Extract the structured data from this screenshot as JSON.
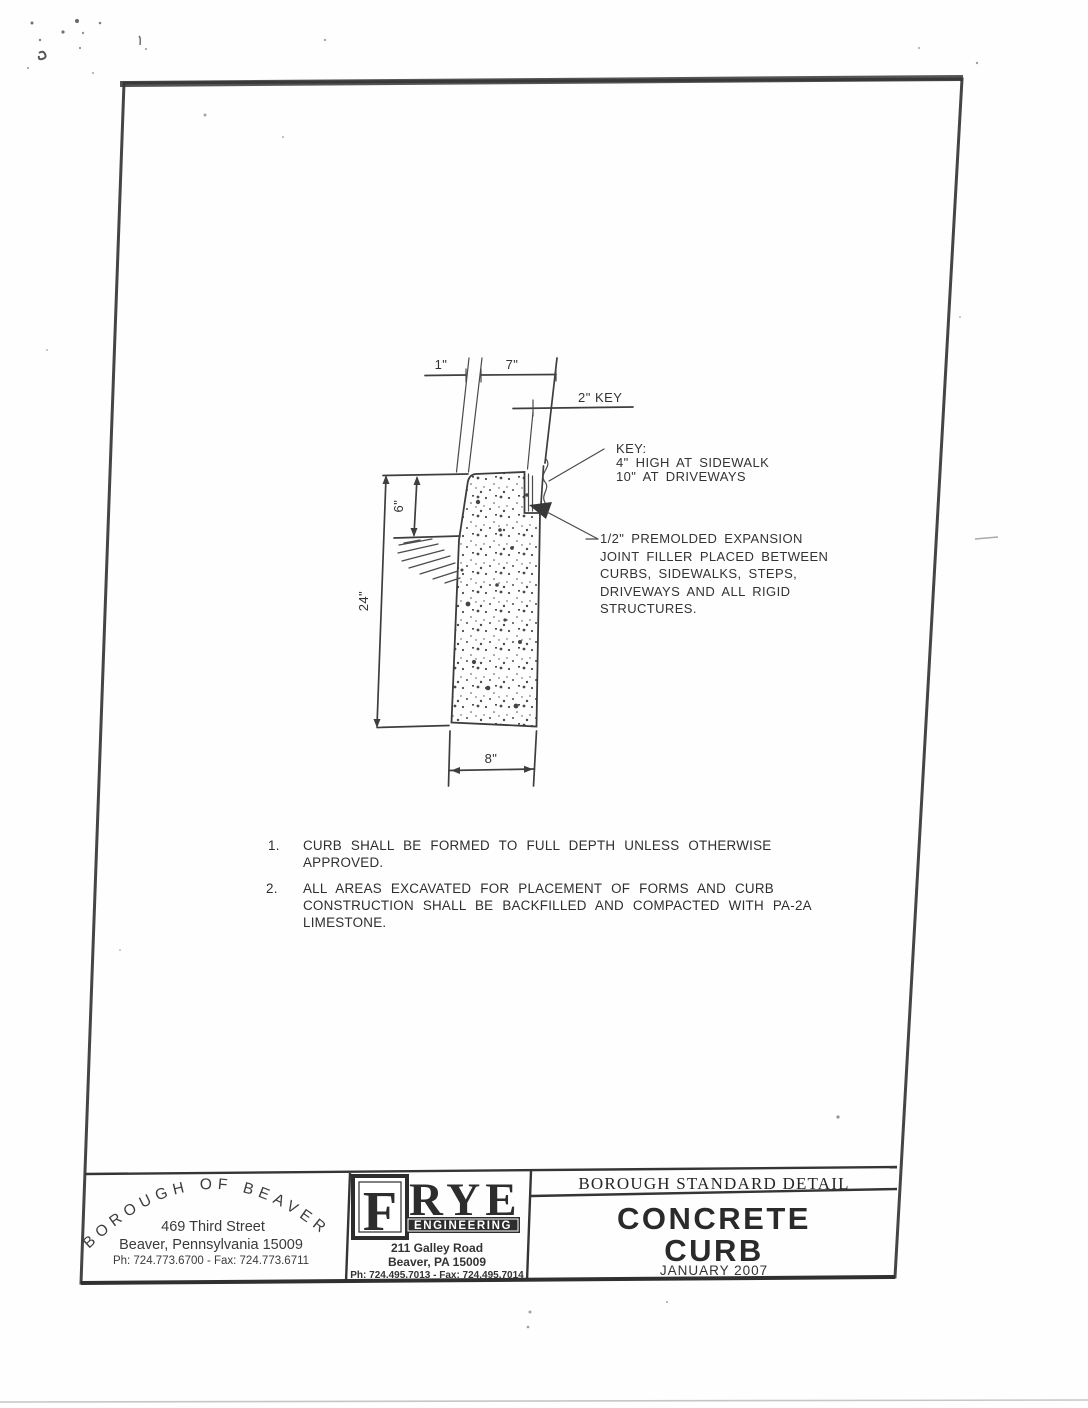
{
  "drawing": {
    "dims": {
      "batter": "1\"",
      "top_width": "7\"",
      "key_width": "2\" KEY",
      "reveal": "6\"",
      "depth": "24\"",
      "base": "8\""
    },
    "key_note": {
      "l1": "KEY:",
      "l2": "4\" HIGH AT SIDEWALK",
      "l3": "10\" AT DRIVEWAYS"
    },
    "joint_note": {
      "l1": "1/2\" PREMOLDED EXPANSION",
      "l2": "JOINT FILLER PLACED BETWEEN",
      "l3": "CURBS, SIDEWALKS, STEPS,",
      "l4": "DRIVEWAYS AND ALL RIGID",
      "l5": "STRUCTURES."
    }
  },
  "notes": {
    "n1": {
      "num": "1.",
      "line1": "CURB SHALL BE FORMED TO FULL DEPTH UNLESS OTHERWISE",
      "line2": "APPROVED."
    },
    "n2": {
      "num": "2.",
      "line1": "ALL AREAS EXCAVATED FOR PLACEMENT OF FORMS AND CURB",
      "line2": "CONSTRUCTION SHALL BE BACKFILLED AND COMPACTED WITH PA-2A",
      "line3": "LIMESTONE."
    }
  },
  "title_block": {
    "borough": {
      "arc": "BOROUGH OF BEAVER",
      "address1": "469 Third Street",
      "address2": "Beaver, Pennsylvania 15009",
      "phone": "Ph: 724.773.6700   -   Fax: 724.773.6711"
    },
    "frye": {
      "initial": "F",
      "name": "RYE",
      "tagline": "ENGINEERING",
      "address1": "211 Galley Road",
      "address2": "Beaver, PA 15009",
      "phone": "Ph: 724.495.7013  - Fax: 724.495.7014"
    },
    "standard": {
      "header": "BOROUGH STANDARD DETAIL",
      "title_line1": "CONCRETE",
      "title_line2": "CURB",
      "date": "JANUARY 2007"
    }
  },
  "colors": {
    "ink": "#3e3e3e",
    "paper": "#fefefe",
    "logo_bar": "#2d2d2d"
  }
}
